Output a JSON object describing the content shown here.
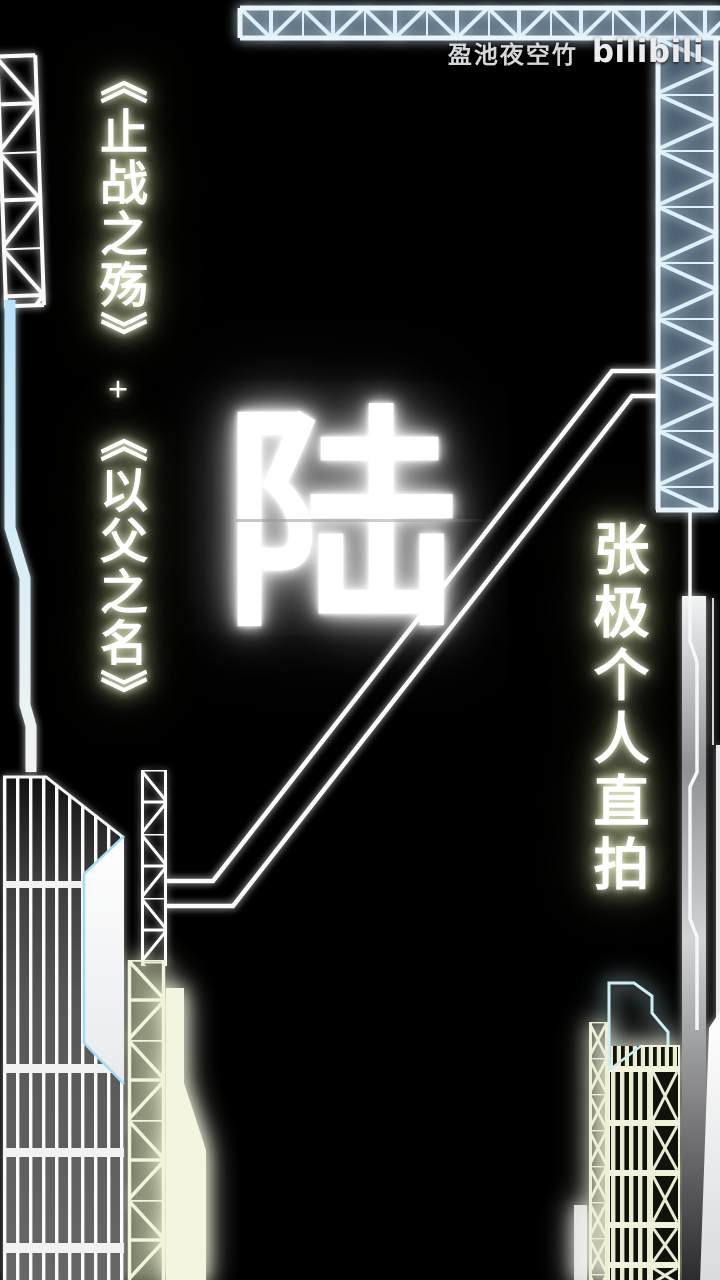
{
  "canvas": {
    "width": 720,
    "height": 1280,
    "background": "#000000"
  },
  "watermark": {
    "artist": "盈池夜空竹",
    "logo": "bilibili"
  },
  "titles": {
    "left_primary": "《止战之殇》",
    "separator": "+",
    "left_secondary": "《以父之名》",
    "right": "张极个人直拍"
  },
  "center_glyph": {
    "char": "陆"
  },
  "colors": {
    "background": "#000000",
    "truss_blue": "#dff0fc",
    "line_white": "#ffffff",
    "glow_cream": "#e9efc8",
    "outline_cyan": "#a5dbf2",
    "building_cream": "#eef0d6",
    "watermark_gray": "#d6d7d9"
  }
}
